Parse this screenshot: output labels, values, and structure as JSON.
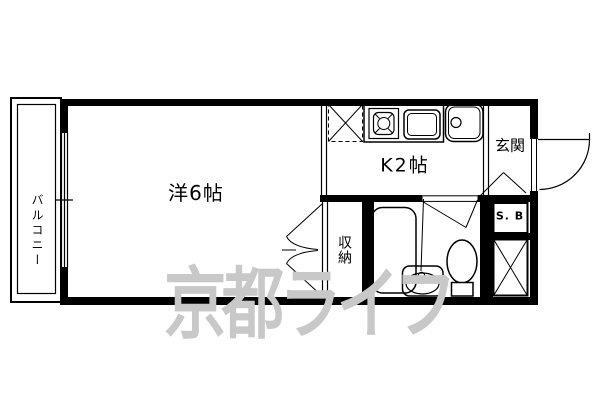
{
  "floorplan": {
    "labels": {
      "balcony": "バルコニー",
      "living_room": "洋6帖",
      "kitchen": "K2帖",
      "entrance": "玄関",
      "closet": "収納",
      "shoe_box": "S. B"
    },
    "watermark": {
      "text": "京都ライフ",
      "color": "#c8c8c8"
    },
    "colors": {
      "line": "#000000",
      "background": "#ffffff"
    }
  }
}
